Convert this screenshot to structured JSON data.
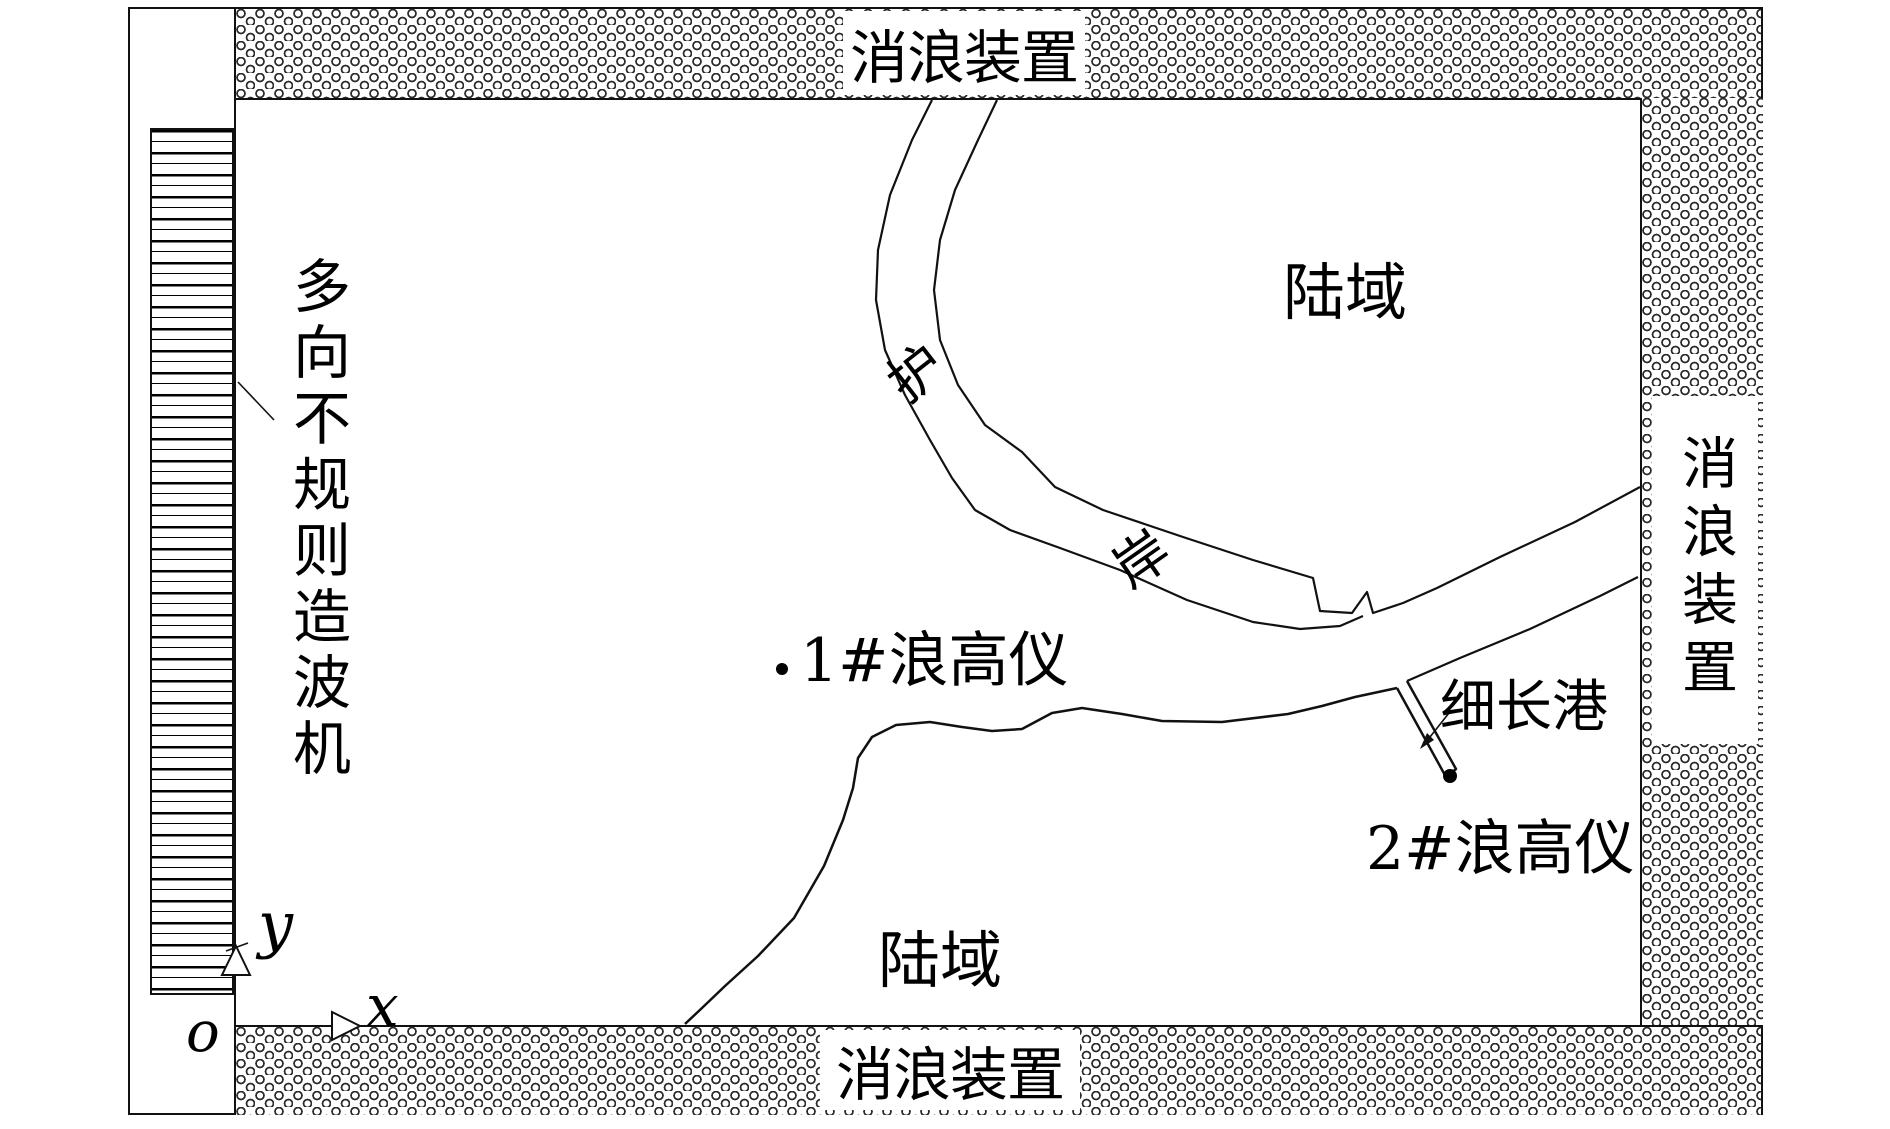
{
  "figure": {
    "title": "wave-basin-experiment-layout",
    "labels": {
      "absorber_top": "消浪装置",
      "absorber_right": "消浪装置",
      "absorber_bottom": "消浪装置",
      "wavemaker": "多向不规则造波机",
      "land_upper": "陆域",
      "land_lower": "陆域",
      "revetment_char_upper": "护",
      "revetment_char_lower": "岸",
      "narrow_harbor": "细长港",
      "gauge_1": "1#浪高仪",
      "gauge_2": "2#浪高仪"
    },
    "axes": {
      "origin": "o",
      "x": "x",
      "y": "y"
    },
    "colors": {
      "ink": "#000000",
      "paper": "#ffffff"
    }
  }
}
